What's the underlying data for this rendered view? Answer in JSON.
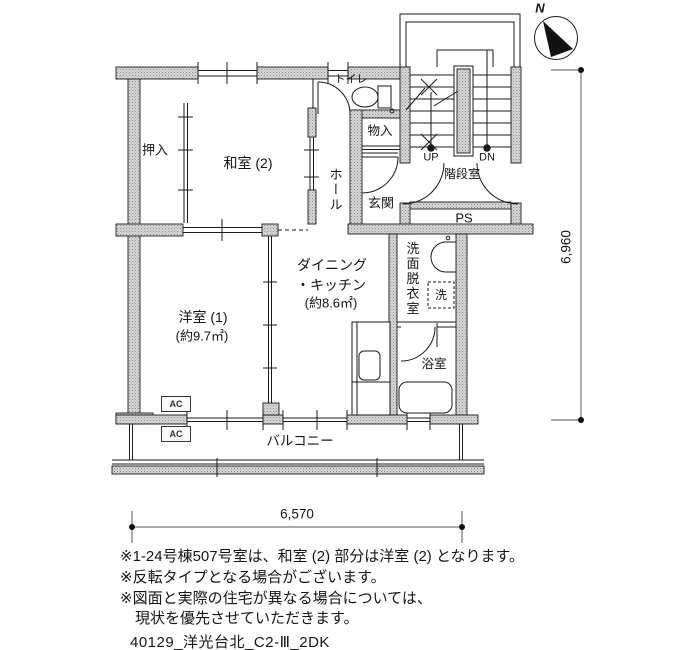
{
  "compass": {
    "north_label": "N"
  },
  "labels": {
    "oshiire": "押入",
    "washitsu2": "和室 (2)",
    "toilet": "トイレ",
    "monoire": "物入",
    "hall": "ホール",
    "genkan": "玄関",
    "up": "UP",
    "dn": "DN",
    "stairwell": "階段室",
    "ps": "PS",
    "yoshitsu1_name": "洋室 (1)",
    "yoshitsu1_area": "(約9.7㎡)",
    "dk_line1": "ダイニング",
    "dk_line2": "・キッチン",
    "dk_area": "(約8.6㎡)",
    "senmen": "洗面脱衣室",
    "laundry": "洗",
    "bathroom": "浴室",
    "balcony": "バルコニー",
    "ac1": "AC",
    "ac2": "AC"
  },
  "dimensions": {
    "horizontal": "6,570",
    "vertical": "6,960"
  },
  "notes": [
    "※1-24号棟507号室は、和室 (2) 部分は洋室 (2) となります。",
    "※反転タイプとなる場合がございます。",
    "※図面と実際の住宅が異なる場合については、",
    "　現状を優先させていただきます。"
  ],
  "plan_id": "40129_洋光台北_C2-Ⅲ_2DK",
  "colors": {
    "wall_fill": "#d6d6d6",
    "line": "#1a1a1a",
    "background": "#ffffff"
  }
}
